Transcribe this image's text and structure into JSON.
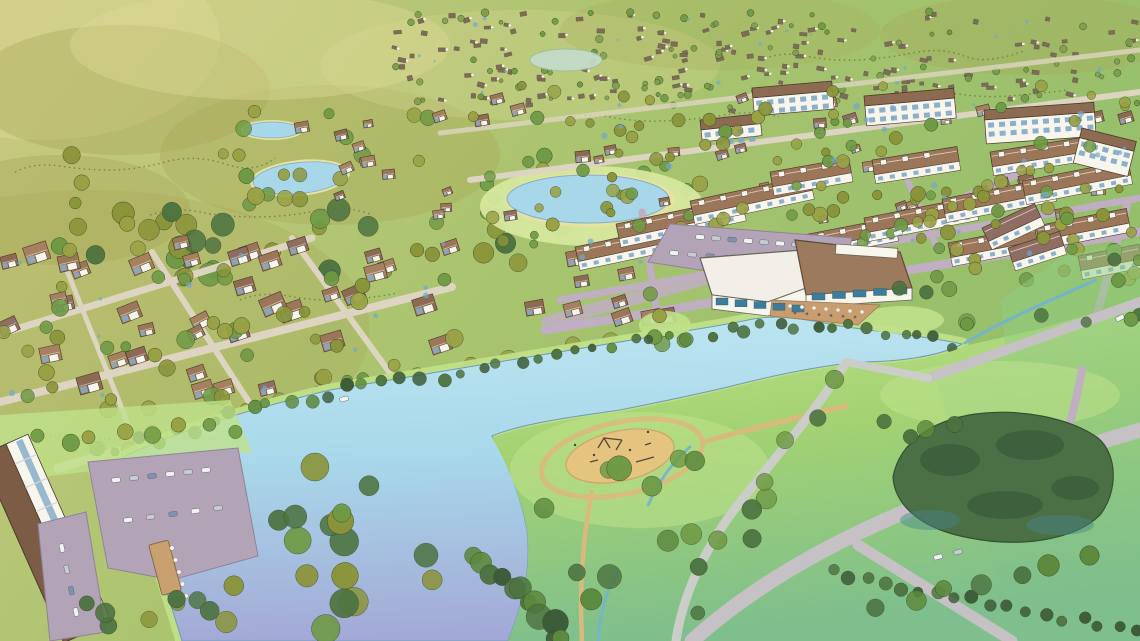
{
  "meta": {
    "description": "Watercolor aerial rendering of a master-planned lakeside community: rolling olive hills, distant subdivisions, ponds, single-family neighborhoods, townhouse rows, apartment blocks, an amenity center with parking and lakeside patio, a large lake with dock, lawn park with playground, paths, creek, forest grove and meadows.",
    "style": "hand-painted watercolor site rendering",
    "text_content": "none"
  },
  "palette": {
    "wash_tl": "#cbc981",
    "wash_mid": "#aac46f",
    "wash_tr": "#93be6b",
    "hill_shade": "#a8a757",
    "hill_light": "#dcd795",
    "scribble": "#5f652f",
    "distant_roof": "#7d6c57",
    "pond": "#a7d7e9",
    "pond_shore": "#e6e3a2",
    "pond_green": "#c5dccc",
    "midpond_lawn": "#d6e79e",
    "lake_top": "#bfe6f2",
    "lake_mid": "#a8d8ea",
    "lake_bottom": "#a3a9d6",
    "lake_edge": "#bfe087",
    "lake_line": "#6f9ab8",
    "park_light": "#bfe18a",
    "park_green": "#a3d272",
    "field_green": "#8fcd80",
    "field_teal": "#7fbf8d",
    "forest_dark": "#4c7045",
    "forest_deep": "#3c5c39",
    "forest_teal": "#47858c",
    "playground_sand": "#e5c480",
    "path_tan": "#d9ba7d",
    "path_gray": "#cbcec8",
    "road_light": "#ddd5c1",
    "road_mauve": "#c0aec3",
    "road_gray": "#c6c1c4",
    "parking": "#b2a4b6",
    "roof_brown": "#8d6b52",
    "roof_brown2": "#9b7659",
    "roof_brown3": "#a5815f",
    "roof_dark": "#7c5c45",
    "roof_mauve": "#8f6d62",
    "facade_white": "#f8f5ec",
    "facade_blue": "#89b1cf",
    "window_teal": "#3e7d9a",
    "window_blue": "#7fa9c6",
    "amenity_roof_white": "#f1efe7",
    "amenity_roof_brown": "#9c7a5d",
    "patio": "#c99d6f",
    "tree_olive": "#99a144",
    "tree_olive2": "#8a9439",
    "tree_green": "#6f9a45",
    "tree_green2": "#5d8a3e",
    "tree_dark": "#4c7340",
    "tree_small": "#7da04e",
    "water_dab": "#6fa8cf",
    "stream": "#6fb3d4",
    "car_white": "#f2f2f2",
    "car_gray": "#c7ccd2",
    "car_blue": "#7e92b4",
    "dock": "#c9a070"
  },
  "scene": {
    "distant": {
      "x": 385,
      "y": 12,
      "w": 750,
      "h": 96,
      "n": 150,
      "seed": 3,
      "layer": "g-distant"
    },
    "trees": [
      {
        "layer": "g-upper",
        "x": 80,
        "y": 205,
        "w": 500,
        "h": 75,
        "count": 30,
        "rmin": 7,
        "rmax": 12,
        "colors": [
          "tree_green",
          "tree_dark",
          "tree_olive2"
        ],
        "seed": 41
      },
      {
        "layer": "g-upper",
        "x": 230,
        "y": 110,
        "w": 220,
        "h": 100,
        "count": 14,
        "rmin": 5,
        "rmax": 9,
        "colors": [
          "tree_olive",
          "tree_green"
        ],
        "seed": 42
      },
      {
        "layer": "g-upper",
        "x": 0,
        "y": 150,
        "w": 300,
        "h": 90,
        "count": 10,
        "rmin": 5,
        "rmax": 9,
        "colors": [
          "tree_olive2",
          "tree_olive"
        ],
        "seed": 43
      },
      {
        "layer": "g-upper",
        "x": 485,
        "y": 155,
        "w": 215,
        "h": 70,
        "count": 12,
        "rmin": 5,
        "rmax": 8,
        "colors": [
          "tree_olive",
          "tree_green"
        ],
        "seed": 44
      },
      {
        "layer": "g-distant",
        "x": 390,
        "y": 10,
        "w": 748,
        "h": 100,
        "count": 90,
        "rmin": 2,
        "rmax": 4,
        "colors": [
          "tree_small",
          "tree_green"
        ],
        "seed": 45
      },
      {
        "layer": "g-left-trees",
        "x": 0,
        "y": 245,
        "w": 460,
        "h": 165,
        "count": 55,
        "rmin": 5,
        "rmax": 9,
        "colors": [
          "tree_olive",
          "tree_olive2",
          "tree_green"
        ],
        "seed": 46,
        "clip": {
          "x1": 0,
          "y1": 482,
          "x2": 650,
          "y2": 338
        },
        "clipGap": 8
      },
      {
        "layer": "g-left-trees",
        "points": [
          [
            95,
            455
          ],
          [
            280,
            408
          ],
          [
            470,
            372
          ],
          [
            635,
            340
          ]
        ],
        "jitter": 8,
        "count": 18,
        "rmin": 6,
        "rmax": 9,
        "colors": [
          "tree_olive",
          "tree_green"
        ],
        "seed": 47
      },
      {
        "layer": "g-right-trees",
        "x": 430,
        "y": 85,
        "w": 710,
        "h": 160,
        "count": 80,
        "rmin": 4,
        "rmax": 7,
        "colors": [
          "tree_olive",
          "tree_olive2",
          "tree_green"
        ],
        "seed": 48
      },
      {
        "layer": "g-right-trees",
        "x": 560,
        "y": 190,
        "w": 580,
        "h": 90,
        "count": 40,
        "rmin": 5,
        "rmax": 8,
        "colors": [
          "tree_olive",
          "tree_green",
          "tree_olive2"
        ],
        "seed": 49
      },
      {
        "layer": "g-right-trees",
        "points": [
          [
            838,
            256
          ],
          [
            1014,
            176
          ]
        ],
        "jitter": 9,
        "count": 12,
        "rmin": 5,
        "rmax": 7,
        "colors": [
          "tree_olive",
          "tree_green"
        ],
        "seed": 50
      },
      {
        "layer": "g-amenity-trees",
        "x": 640,
        "y": 290,
        "w": 70,
        "h": 55,
        "count": 5,
        "rmin": 6,
        "rmax": 9,
        "colors": [
          "tree_green",
          "tree_olive"
        ],
        "seed": 51
      },
      {
        "layer": "g-amenity-trees",
        "x": 880,
        "y": 288,
        "w": 90,
        "h": 55,
        "count": 5,
        "rmin": 6,
        "rmax": 9,
        "colors": [
          "tree_green",
          "tree_dark"
        ],
        "seed": 52
      },
      {
        "layer": "g-banks",
        "points": [
          [
            120,
            448
          ],
          [
            300,
            398
          ],
          [
            480,
            368
          ],
          [
            640,
            342
          ],
          [
            700,
            334
          ],
          [
            748,
            326
          ]
        ],
        "jitter": 6,
        "count": 34,
        "rmin": 4,
        "rmax": 7,
        "colors": [
          "tree_dark",
          "forest_deep",
          "tree_green2"
        ],
        "seed": 53
      },
      {
        "layer": "g-banks",
        "points": [
          [
            762,
            322
          ],
          [
            860,
            328
          ],
          [
            955,
            344
          ]
        ],
        "jitter": 5,
        "count": 12,
        "rmin": 4,
        "rmax": 6,
        "colors": [
          "tree_dark",
          "forest_deep"
        ],
        "seed": 54
      },
      {
        "layer": "g-park-trees",
        "x": 480,
        "y": 415,
        "w": 290,
        "h": 185,
        "count": 13,
        "rmin": 8,
        "rmax": 14,
        "colors": [
          "tree_green",
          "tree_green2",
          "tree_dark"
        ],
        "seed": 55
      },
      {
        "layer": "g-park-trees",
        "points": [
          [
            840,
            380
          ],
          [
            780,
            460
          ],
          [
            720,
            540
          ],
          [
            690,
            610
          ]
        ],
        "jitter": 8,
        "count": 8,
        "rmin": 7,
        "rmax": 10,
        "colors": [
          "tree_green",
          "tree_dark"
        ],
        "seed": 56
      },
      {
        "layer": "g-park-trees",
        "points": [
          [
            470,
            560
          ],
          [
            530,
            600
          ],
          [
            565,
            641
          ]
        ],
        "jitter": 7,
        "count": 12,
        "rmin": 8,
        "rmax": 13,
        "colors": [
          "tree_dark",
          "tree_green2",
          "forest_deep"
        ],
        "seed": 57
      },
      {
        "layer": "g-bl-trees",
        "x": 255,
        "y": 455,
        "w": 180,
        "h": 186,
        "count": 16,
        "rmin": 9,
        "rmax": 15,
        "colors": [
          "tree_olive2",
          "tree_green",
          "tree_dark"
        ],
        "seed": 58
      },
      {
        "layer": "g-bl-trees",
        "x": 70,
        "y": 585,
        "w": 200,
        "h": 56,
        "count": 10,
        "rmin": 7,
        "rmax": 12,
        "colors": [
          "tree_olive2",
          "tree_dark"
        ],
        "seed": 59
      },
      {
        "layer": "g-bl-trees",
        "points": [
          [
            40,
            440
          ],
          [
            230,
            425
          ]
        ],
        "jitter": 7,
        "count": 8,
        "rmin": 6,
        "rmax": 9,
        "colors": [
          "tree_olive",
          "tree_green"
        ],
        "seed": 60
      },
      {
        "layer": "g-field-trees",
        "x": 860,
        "y": 390,
        "w": 120,
        "h": 55,
        "count": 4,
        "rmin": 6,
        "rmax": 9,
        "colors": [
          "tree_dark",
          "tree_green2"
        ],
        "seed": 61
      },
      {
        "layer": "g-field-trees",
        "points": [
          [
            832,
            572
          ],
          [
            1135,
            632
          ]
        ],
        "jitter": 4,
        "count": 18,
        "rmin": 5,
        "rmax": 7,
        "colors": [
          "tree_dark",
          "forest_deep"
        ],
        "seed": 62
      },
      {
        "layer": "g-field-trees",
        "points": [
          [
            878,
            612
          ],
          [
            1088,
            556
          ]
        ],
        "jitter": 5,
        "count": 7,
        "rmin": 8,
        "rmax": 11,
        "colors": [
          "tree_dark",
          "tree_green2"
        ],
        "seed": 63
      },
      {
        "layer": "g-field-trees",
        "x": 1000,
        "y": 240,
        "w": 140,
        "h": 95,
        "count": 8,
        "rmin": 5,
        "rmax": 8,
        "colors": [
          "tree_green",
          "tree_dark"
        ],
        "seed": 64
      }
    ],
    "houses": [
      {
        "layer": "g-left",
        "x": 8,
        "y": 238,
        "w": 450,
        "h": 178,
        "count": 42,
        "smin": 15,
        "smax": 24,
        "angle": -20,
        "ja": 16,
        "seed": 11,
        "roofs": [
          "roof_brown",
          "roof_brown2",
          "roof_brown3",
          "roof_mauve"
        ],
        "clip": {
          "x1": 0,
          "y1": 482,
          "x2": 650,
          "y2": 338
        },
        "clipGap": 16
      },
      {
        "layer": "g-left",
        "x": 300,
        "y": 122,
        "w": 160,
        "h": 84,
        "count": 10,
        "smin": 9,
        "smax": 14,
        "angle": -15,
        "ja": 20,
        "seed": 7,
        "roofs": [
          "roof_brown",
          "roof_brown2",
          "roof_brown3"
        ]
      },
      {
        "layer": "g-right",
        "x": 432,
        "y": 90,
        "w": 704,
        "h": 130,
        "count": 50,
        "smin": 9,
        "smax": 15,
        "angle": -12,
        "ja": 18,
        "seed": 23,
        "roofs": [
          "roof_brown",
          "roof_brown2",
          "roof_brown3",
          "roof_mauve"
        ]
      },
      {
        "layer": "g-right",
        "x": 528,
        "y": 252,
        "w": 140,
        "h": 78,
        "count": 9,
        "smin": 14,
        "smax": 20,
        "angle": -14,
        "ja": 12,
        "seed": 31,
        "roofs": [
          "roof_brown",
          "roof_brown2",
          "roof_brown3"
        ]
      }
    ],
    "townhouse_rows": [
      {
        "x": 575,
        "y": 247,
        "len": 100,
        "ang": -12
      },
      {
        "x": 616,
        "y": 224,
        "len": 128,
        "ang": -12
      },
      {
        "x": 690,
        "y": 201,
        "len": 122,
        "ang": -12
      },
      {
        "x": 788,
        "y": 238,
        "len": 108,
        "ang": -11
      },
      {
        "x": 864,
        "y": 218,
        "len": 112,
        "ang": -11
      },
      {
        "x": 942,
        "y": 199,
        "len": 112,
        "ang": -11
      },
      {
        "x": 1022,
        "y": 181,
        "len": 108,
        "ang": -11
      },
      {
        "x": 948,
        "y": 243,
        "len": 88,
        "ang": -11
      },
      {
        "x": 1036,
        "y": 226,
        "len": 92,
        "ang": -11
      },
      {
        "x": 990,
        "y": 152,
        "len": 100,
        "ang": -9
      },
      {
        "x": 1078,
        "y": 256,
        "len": 62,
        "ang": -11
      },
      {
        "x": 872,
        "y": 160,
        "len": 86,
        "ang": -9
      },
      {
        "x": 770,
        "y": 172,
        "len": 80,
        "ang": -10
      },
      {
        "x": 982,
        "y": 228,
        "len": 58,
        "ang": -25,
        "roof": "roof_mauve",
        "plain": true
      },
      {
        "x": 1008,
        "y": 248,
        "len": 54,
        "ang": -18,
        "roof": "roof_mauve",
        "plain": true
      }
    ],
    "apartments": [
      {
        "x": 752,
        "y": 88,
        "len": 80,
        "ht": 28,
        "ang": -5
      },
      {
        "x": 864,
        "y": 96,
        "len": 90,
        "ht": 30,
        "ang": -5
      },
      {
        "x": 984,
        "y": 110,
        "len": 110,
        "ht": 34,
        "ang": -4
      },
      {
        "x": 1082,
        "y": 128,
        "len": 56,
        "ht": 36,
        "ang": 14
      },
      {
        "x": 700,
        "y": 120,
        "len": 60,
        "ht": 22,
        "ang": -6
      }
    ],
    "car_rows": [
      {
        "x1": 700,
        "y1": 237,
        "x2": 812,
        "y2": 246,
        "n": 8,
        "layer": "g-amenity-cars"
      },
      {
        "x1": 674,
        "y1": 253,
        "x2": 764,
        "y2": 261,
        "n": 6,
        "layer": "g-amenity-cars"
      },
      {
        "x1": 898,
        "y1": 233,
        "x2": 910,
        "y2": 229,
        "n": 1,
        "layer": "g-amenity-cars"
      },
      {
        "x1": 116,
        "y1": 480,
        "x2": 206,
        "y2": 470,
        "n": 6,
        "layer": "g-bl-cars"
      },
      {
        "x1": 128,
        "y1": 520,
        "x2": 218,
        "y2": 508,
        "n": 5,
        "layer": "g-bl-cars"
      },
      {
        "x1": 62,
        "y1": 548,
        "x2": 76,
        "y2": 612,
        "n": 4,
        "layer": "g-bl-cars"
      },
      {
        "x1": 344,
        "y1": 399,
        "x2": 356,
        "y2": 396,
        "n": 1,
        "layer": "g-bl-cars"
      },
      {
        "x1": 1120,
        "y1": 318,
        "x2": 1132,
        "y2": 312,
        "n": 1,
        "layer": "g-field-cars"
      },
      {
        "x1": 938,
        "y1": 557,
        "x2": 958,
        "y2": 552,
        "n": 2,
        "layer": "g-field-cars"
      }
    ],
    "window_strips": [
      {
        "x1": 716,
        "y1": 298,
        "x2": 792,
        "y2": 305,
        "n": 5,
        "w": 12,
        "h": 7,
        "color": "window_teal",
        "layer": "g-amenity"
      },
      {
        "x1": 812,
        "y1": 293,
        "x2": 894,
        "y2": 287,
        "n": 5,
        "w": 13,
        "h": 7,
        "color": "window_teal",
        "layer": "g-amenity"
      }
    ],
    "dot_rows": [
      {
        "x1": 790,
        "y1": 306,
        "x2": 862,
        "y2": 312,
        "n": 7,
        "r": 2,
        "color": "facade_white",
        "layer": "g-amenity"
      },
      {
        "x1": 795,
        "y1": 313,
        "x2": 855,
        "y2": 317,
        "n": 6,
        "r": 1.3,
        "color": "roof_dark",
        "layer": "g-amenity"
      },
      {
        "x1": 172,
        "y1": 548,
        "x2": 186,
        "y2": 596,
        "n": 5,
        "r": 2.2,
        "color": "facade_white",
        "layer": "g-bl-dock"
      }
    ],
    "dabs": [
      {
        "layer": "g-dabs",
        "x": 430,
        "y": 105,
        "w": 700,
        "h": 175,
        "count": 26,
        "rmin": 1.5,
        "rmax": 3.5,
        "seed": 5,
        "color": "water_dab"
      },
      {
        "layer": "g-dabs",
        "x": 10,
        "y": 255,
        "w": 440,
        "h": 150,
        "count": 14,
        "rmin": 1.5,
        "rmax": 3,
        "seed": 6,
        "color": "water_dab",
        "clip": {
          "x1": 0,
          "y1": 482,
          "x2": 650,
          "y2": 338
        },
        "clipGap": 14
      },
      {
        "layer": "g-distant",
        "x": 390,
        "y": 15,
        "w": 740,
        "h": 90,
        "count": 22,
        "rmin": 1,
        "rmax": 2.5,
        "seed": 8,
        "color": "water_dab"
      }
    ]
  }
}
